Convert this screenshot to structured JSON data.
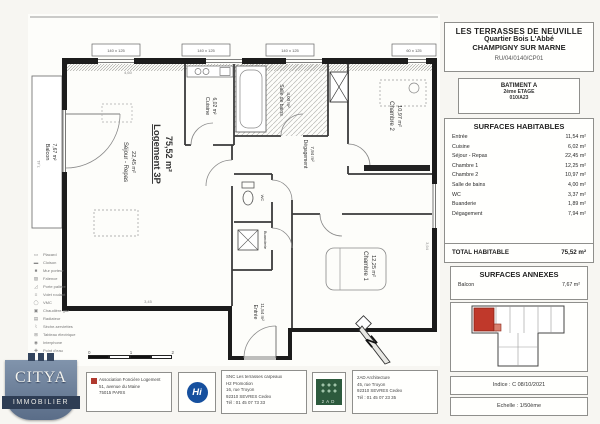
{
  "project": {
    "title1": "LES TERRASSES DE NEUVILLE",
    "title2": "Quartier Bois L'Abbé",
    "title3": "CHAMPIGNY SUR MARNE",
    "ref": "RU/04/0140/CP01",
    "batiment": "BATIMENT A",
    "etage": "2ème ETAGE",
    "lot": "010/A23"
  },
  "surfaces": {
    "title": "SURFACES HABITABLES",
    "rows": [
      {
        "label": "Entrée",
        "value": "11,54 m²"
      },
      {
        "label": "Cuisine",
        "value": "6,02 m²"
      },
      {
        "label": "Séjour - Repas",
        "value": "22,45 m²"
      },
      {
        "label": "Chambre 1",
        "value": "12,25 m²"
      },
      {
        "label": "Chambre 2",
        "value": "10,97 m²"
      },
      {
        "label": "Salle de bains",
        "value": "4,00 m²"
      },
      {
        "label": "WC",
        "value": "3,37 m²"
      },
      {
        "label": "Buanderie",
        "value": "1,89 m²"
      },
      {
        "label": "Dégagement",
        "value": "7,94 m²"
      }
    ],
    "total_label": "TOTAL HABITABLE",
    "total_value": "75,52 m²",
    "annexes_title": "SURFACES ANNEXES",
    "annexes": [
      {
        "label": "Balcon",
        "value": "7,67 m²"
      }
    ]
  },
  "meta": {
    "indice": "Indice : C  08/10/2021",
    "echelle": "Echelle : 1/50ème"
  },
  "plan": {
    "logement": {
      "name": "Logement 3P",
      "area": "75,52 m²"
    },
    "rooms": {
      "sejour": {
        "name": "Séjour - Repas",
        "area": "22,45 m²"
      },
      "cuisine": {
        "name": "Cuisine",
        "area": "6,02 m²"
      },
      "sdb": {
        "name": "Salle de bains",
        "area": "4,00 m²"
      },
      "chambre2": {
        "name": "Chambre 2",
        "area": "10,97 m²"
      },
      "chambre1": {
        "name": "Chambre 1",
        "area": "12,25 m²"
      },
      "degagement": {
        "name": "Dégagement",
        "area": "7,94 m²"
      },
      "wc": {
        "name": "WC",
        "area": "3,37 m²"
      },
      "buanderie": {
        "name": "Buanderie",
        "area": "1,89 m²"
      },
      "entree": {
        "name": "Entrée",
        "area": "11,54 m²"
      },
      "balcon": {
        "name": "Balcon",
        "area": "7,67 m²"
      }
    },
    "windows": [
      "140 x 125",
      "140 x 125",
      "140 x 125",
      "60 x 125"
    ],
    "dims": [
      "7,41",
      "4,60",
      "3,94",
      "3,45"
    ],
    "north": "N",
    "scale": [
      "0",
      "1",
      "2"
    ]
  },
  "legend": {
    "items": [
      "Placard",
      "Cloison",
      "Mur porteur",
      "Faïence",
      "Porte palière",
      "Volet roulant",
      "VMC",
      "Chaudière gaz",
      "Radiateur",
      "Sèche-serviettes",
      "Tableau électrique",
      "Interphone",
      "Point d'eau"
    ],
    "symbols": [
      "▭",
      "▬",
      "■",
      "▨",
      "◿",
      "≡",
      "◯",
      "▣",
      "▤",
      "⌇",
      "⊞",
      "◉",
      "✚"
    ]
  },
  "footer": {
    "citya": {
      "name": "CITYA",
      "sub": "IMMOBILIER"
    },
    "afl": [
      "Association Foncière Logement",
      "51, avenue du Maine",
      "75015 PARIS"
    ],
    "hi": "Hi",
    "snc": [
      "SNC Les terrasses carpeaux",
      "H2 Promotion",
      "16, rue Troyon",
      "92310 SEVRES Cedex",
      "Tél : 01 45 07 73 33"
    ],
    "aad_logo": "2AD",
    "aad": [
      "2AD Architecture",
      "45, rue Troyon",
      "92310 SEVRES Cedex",
      "Tél : 01 45 07 23 35"
    ]
  },
  "colors": {
    "highlight": "#c0392b",
    "citya_blue": "#5d7190",
    "hi_blue": "#16509e",
    "aad_green": "#2d5a3d"
  }
}
